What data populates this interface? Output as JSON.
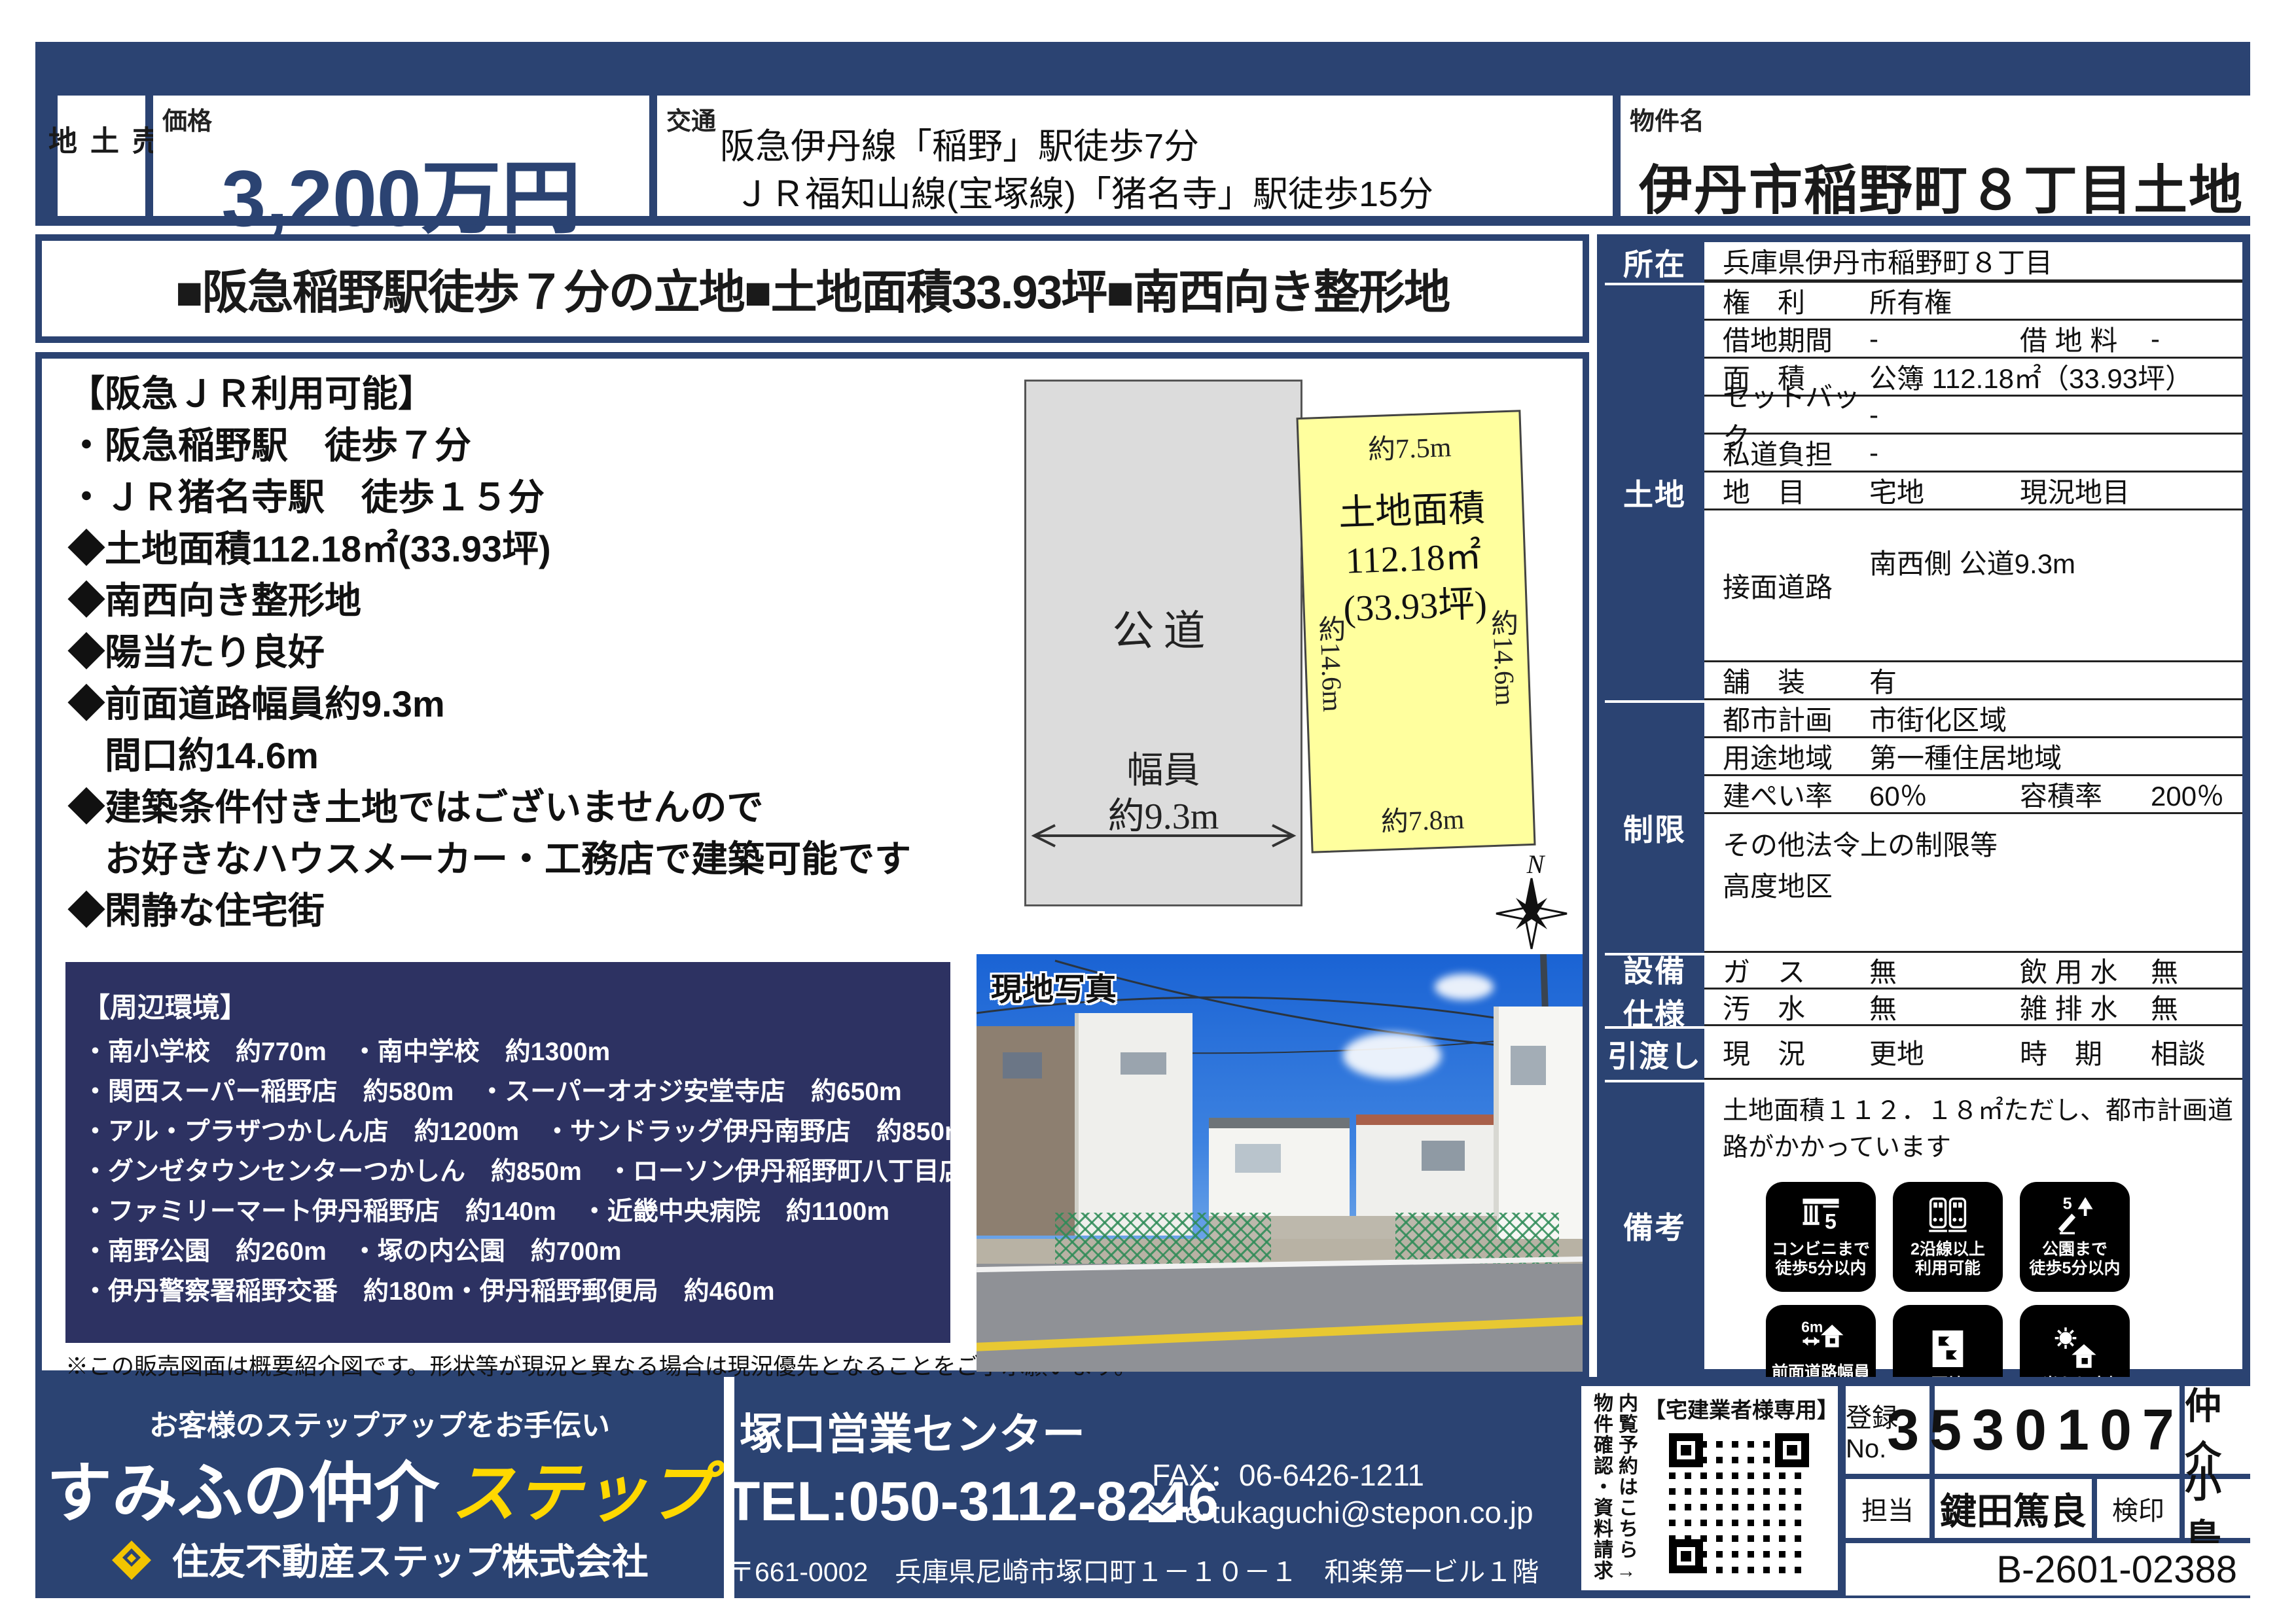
{
  "colors": {
    "navy": "#2b4372",
    "surround_navy": "#2d3262",
    "accent_yellow": "#ffd800",
    "plot_yellow": "#ffff9e",
    "road_gray": "#dcdcdc"
  },
  "header": {
    "sale_type": "売土地",
    "price_label": "価格",
    "price": "3,200万円",
    "access_label": "交通",
    "access_line1": "阪急伊丹線「稲野」駅徒歩7分",
    "access_line2": "ＪＲ福知山線(宝塚線)「猪名寺」駅徒歩15分",
    "property_label": "物件名",
    "property_name": "伊丹市稲野町８丁目土地"
  },
  "headline": "■阪急稲野駅徒歩７分の立地■土地面積33.93坪■南西向き整形地",
  "features": [
    "【阪急ＪＲ利用可能】",
    "・阪急稲野駅　徒歩７分",
    "・ＪＲ猪名寺駅　徒歩１５分",
    "◆土地面積112.18㎡(33.93坪)",
    "◆南西向き整形地",
    "◆陽当たり良好",
    "◆前面道路幅員約9.3m",
    "　間口約14.6m",
    "◆建築条件付き土地ではございませんので",
    "　お好きなハウスメーカー・工務店で建築可能です",
    "◆閑静な住宅街"
  ],
  "diagram": {
    "road_label": "公道",
    "width_label": "幅員",
    "width_value": "約9.3m",
    "top_dim": "約7.5m",
    "left_dim": "約14.6m",
    "right_dim": "約14.6m",
    "bottom_dim": "約7.8m",
    "plot_line1": "土地面積",
    "plot_line2": "112.18㎡",
    "plot_line3": "(33.93坪)",
    "compass_n": "N"
  },
  "surroundings": {
    "title": "【周辺環境】",
    "lines": [
      "・南小学校　約770m　・南中学校　約1300m",
      "・関西スーパー稲野店　約580m　・スーパーオオジ安堂寺店　約650m",
      "・アル・プラザつかしん店　約1200m　・サンドラッグ伊丹南野店　約850m",
      "・グンゼタウンセンターつかしん　約850m　・ローソン伊丹稲野町八丁目店　約110m",
      "・ファミリーマート伊丹稲野店　約140m　・近畿中央病院　約1100m",
      "・南野公園　約260m　・塚の内公園　約700m",
      "・伊丹警察署稲野交番　約180m・伊丹稲野郵便局　約460m"
    ]
  },
  "note": "※この販売図面は概要紹介図です。形状等が現況と異なる場合は現況優先となることをご了承願います。",
  "photo": {
    "label": "現地写真"
  },
  "details": {
    "location_label": "所在",
    "location_value": "兵庫県伊丹市稲野町８丁目",
    "land_label": "土地",
    "rights": {
      "k": "権　利",
      "v": "所有権"
    },
    "lease": {
      "k": "借地期間",
      "v": "-",
      "k2": "借 地 料",
      "v2": "-"
    },
    "area": {
      "k": "面　積",
      "v": "公簿 112.18㎡（33.93坪）"
    },
    "setback": {
      "k": "セットバック",
      "v": "-"
    },
    "private_road": {
      "k": "私道負担",
      "v": "-"
    },
    "category": {
      "k": "地　目",
      "v": "宅地",
      "k2": "現況地目",
      "v2": ""
    },
    "frontage": {
      "k": "接面道路",
      "v": "南西側 公道9.3m"
    },
    "pavement": {
      "k": "舗　装",
      "v": "有"
    },
    "restriction_label": "制限",
    "city_plan": {
      "k": "都市計画",
      "v": "市街化区域"
    },
    "zoning": {
      "k": "用途地域",
      "v": "第一種住居地域"
    },
    "coverage": {
      "k": "建ぺい率",
      "v": "60％",
      "k2": "容積率",
      "v2": "200％"
    },
    "other_restrictions_line1": "その他法令上の制限等",
    "other_restrictions_line2": "高度地区",
    "facility_label_1": "設備",
    "facility_label_2": "仕様",
    "gas": {
      "k": "ガ　ス",
      "v": "無",
      "k2": "飲 用 水",
      "v2": "無"
    },
    "sewage": {
      "k": "汚　水",
      "v": "無",
      "k2": "雑 排 水",
      "v2": "無"
    },
    "handover_label": "引渡し",
    "current": {
      "k": "現　況",
      "v": "更地",
      "k2": "時　期",
      "v2": "相談"
    },
    "remarks_label": "備考",
    "remarks_text": "土地面積１１２．１８㎡ただし、都市計画道路がかかっています",
    "badges": [
      {
        "caption1": "コンビニまで",
        "caption2": "徒歩5分以内"
      },
      {
        "caption1": "2沿線以上",
        "caption2": "利用可能"
      },
      {
        "caption1": "公園まで",
        "caption2": "徒歩5分以内"
      },
      {
        "caption1": "前面道路幅員",
        "caption2": "6m以上"
      },
      {
        "caption1": "更地",
        "caption2": ""
      },
      {
        "caption1": "日当たり良好",
        "caption2": ""
      }
    ]
  },
  "footer": {
    "tagline": "お客様のステップアップをお手伝い",
    "brand_main": "すみふの仲介",
    "brand_accent": "ステップ",
    "company": "住友不動産ステップ株式会社",
    "office": "塚口営業センター",
    "tel": "TEL:050-3112-8246",
    "fax": "FAX：06-6426-1211",
    "email": "e-tukaguchi@stepon.co.jp",
    "address": "〒661-0002　兵庫県尼崎市塚口町１－１０－１　和楽第一ビル１階",
    "qr_header": "【宅建業者様専用】",
    "qr_side1": "内覧予約はこちら→",
    "qr_side2": "物件確認・資料請求",
    "reg_no_label": "登録No.",
    "reg_no": "35301070",
    "chukai": "仲介",
    "tanto_label": "担当",
    "tanto": "鍵田篤良",
    "kenin_label": "検印",
    "kenin": "小島",
    "doc_no": "B-2601-02388"
  }
}
